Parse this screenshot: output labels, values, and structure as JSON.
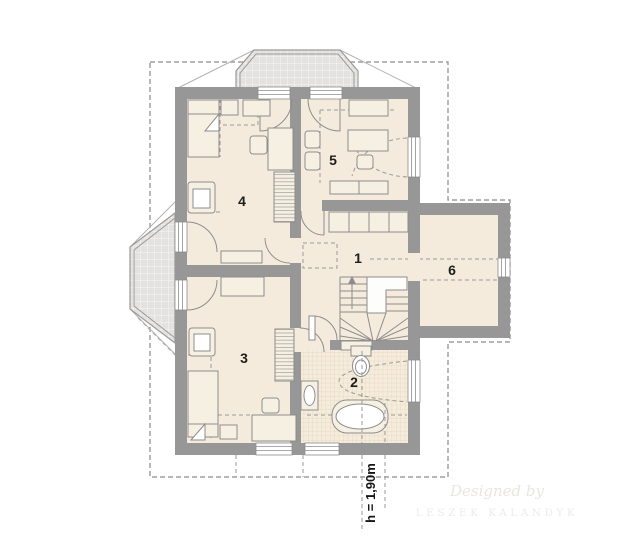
{
  "rooms": [
    {
      "label": "1"
    },
    {
      "label": "2"
    },
    {
      "label": "3"
    },
    {
      "label": "4"
    },
    {
      "label": "5"
    },
    {
      "label": "6"
    }
  ],
  "annotations": {
    "knee_wall_height": "h = 1,90m"
  },
  "watermark": {
    "line1": "Designed by",
    "line2": "LESZEK KALANDYK"
  },
  "colors": {
    "bg": "#ffffff",
    "wall": "#979797",
    "floor": "#f4ebdc",
    "furn": "#f6f0e3",
    "line": "#8d8d8d",
    "dash": "#9a9a9a",
    "roofdash": "#8a8a8a",
    "label": "#1d1d1b",
    "wm1": "#e8e6e2",
    "wm2": "#edebe7",
    "balcony_tile": "#e3e2e0",
    "bath_tile": "#f5ecdb"
  }
}
